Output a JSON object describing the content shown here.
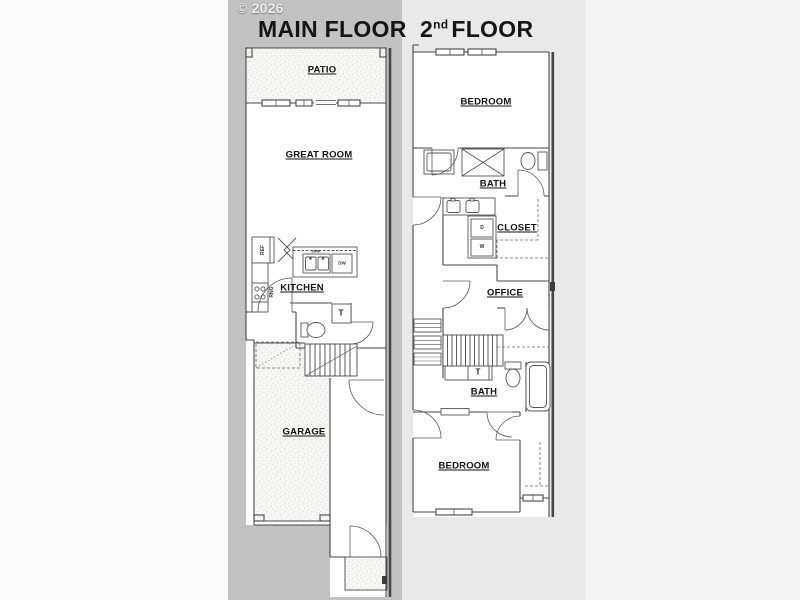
{
  "meta": {
    "copyright": "© 2026"
  },
  "main_floor": {
    "title": "MAIN FLOOR",
    "labels": {
      "patio": "PATIO",
      "great_room": "GREAT ROOM",
      "kitchen": "KITCHEN",
      "garage": "GARAGE"
    },
    "appliances": {
      "refrigerator": "REF",
      "range": "RNG",
      "sink": "SINK",
      "dishwasher": "DW",
      "powder_sink": "T"
    }
  },
  "second_floor": {
    "title": {
      "base": "2",
      "sup": "nd",
      "rest": "FLOOR"
    },
    "labels": {
      "bedroom_top": "BEDROOM",
      "bath_top": "BATH",
      "closet": "CLOSET",
      "office": "OFFICE",
      "bath_lower": "BATH",
      "bedroom_bottom": "BEDROOM"
    },
    "appliances": {
      "dryer": "D",
      "washer": "W",
      "bath_sink": "T"
    }
  },
  "colors": {
    "main_backdrop": "#c2c2c2",
    "second_backdrop": "#e9e9e9",
    "right_margin": "#f4f4f4",
    "page": "#fbfbfb",
    "wall": "#474747",
    "label_text": "#121212",
    "watermark": "#ececec"
  }
}
